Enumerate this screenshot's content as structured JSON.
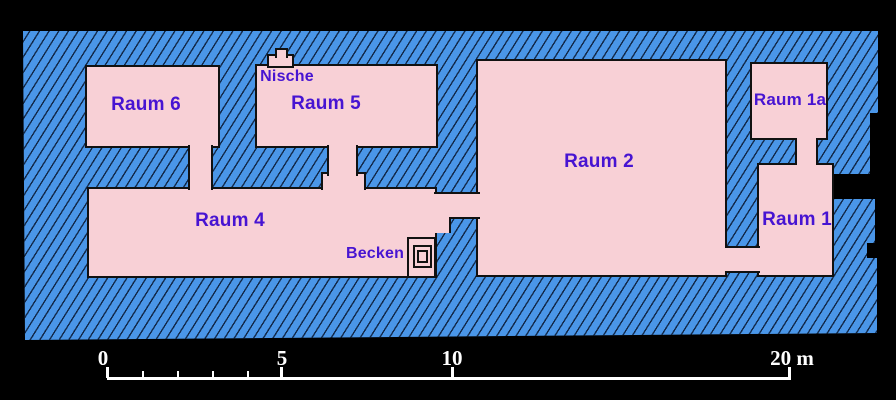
{
  "plan": {
    "rooms": [
      {
        "id": "raum-6",
        "label": "Raum 6"
      },
      {
        "id": "raum-5",
        "label": "Raum 5"
      },
      {
        "id": "raum-2",
        "label": "Raum 2"
      },
      {
        "id": "raum-1a",
        "label": "Raum 1a"
      },
      {
        "id": "raum-4",
        "label": "Raum 4"
      },
      {
        "id": "raum-1",
        "label": "Raum 1"
      }
    ],
    "features": [
      {
        "id": "nische",
        "label": "Nische"
      },
      {
        "id": "becken",
        "label": "Becken"
      }
    ]
  },
  "scale_bar": {
    "tick_labels": [
      "0",
      "5",
      "10"
    ],
    "end_label": "20 m"
  },
  "colors": {
    "background": "#000000",
    "wall_fill": "#4a96e8",
    "hatch_line": "#081c2e",
    "room_fill": "#f8d0d6",
    "outline": "#111111",
    "label_text": "#4714d2",
    "scale_text": "#ffffff"
  }
}
